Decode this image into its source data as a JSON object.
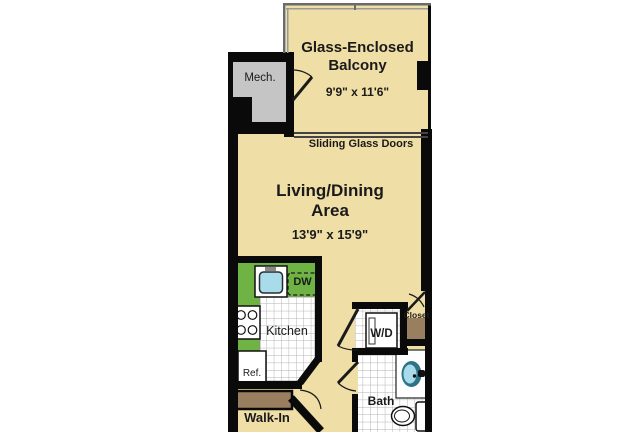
{
  "plan": {
    "rooms": {
      "balcony": {
        "line1": "Glass-Enclosed",
        "line2": "Balcony",
        "dims": "9'9\" x 11'6\""
      },
      "living": {
        "line1": "Living/Dining",
        "line2": "Area",
        "dims": "13'9\" x 15'9\""
      },
      "mech": {
        "name": "Mech."
      },
      "kitchen": {
        "name": "Kitchen"
      },
      "bath": {
        "name": "Bath"
      },
      "walk_in": {
        "name": "Walk-In"
      },
      "closet": {
        "name": "Closet"
      }
    },
    "fixtures": {
      "dishwasher": "DW",
      "refrigerator": "Ref.",
      "washer_dryer": "W/D"
    },
    "annotations": {
      "sliding_doors": "Sliding Glass Doors"
    },
    "colors": {
      "floor_tan": "#EFDEA5",
      "counter_green": "#6FB344",
      "wood_brown": "#9A7E60",
      "mech_gray": "#C5C5C5",
      "fixture_blue": "#A9DCEA",
      "sink_ring_teal": "#2E7486",
      "wall_black": "#0A0A0A",
      "tile_white": "#FFFFFF"
    }
  }
}
